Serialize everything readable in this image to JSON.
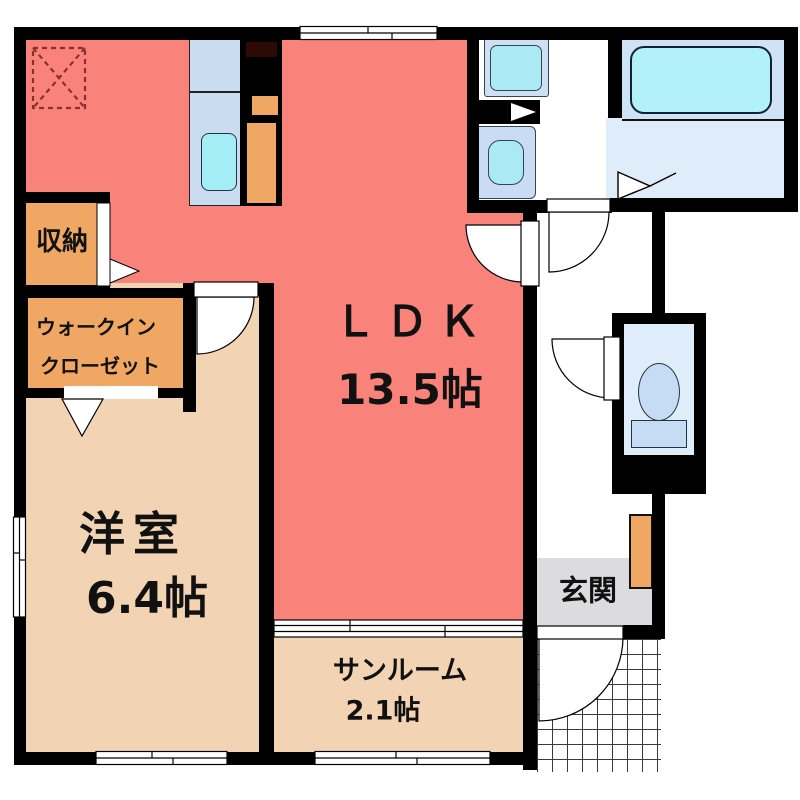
{
  "type": "apartment-floor-plan",
  "rooms": {
    "ldk": {
      "label": "ＬＤＫ",
      "area": "13.5帖",
      "color": "#f9837b"
    },
    "western_room": {
      "label": "洋室",
      "area": "6.4帖",
      "color": "#f2d4b5"
    },
    "sunroom": {
      "label": "サンルーム",
      "area": "2.1帖",
      "color": "#f2d4b5"
    },
    "storage": {
      "label": "収納",
      "color": "#f0a763"
    },
    "walk_in_closet": {
      "label_line1": "ウォークイン",
      "label_line2": "クローゼット",
      "color": "#f0a763"
    },
    "entrance": {
      "label": "玄関",
      "color": "#dcdcde"
    }
  },
  "fixtures": {
    "kitchen_counter": "kitchen-counter-with-sink",
    "refrigerator_space": "refrigerator-space",
    "washing_machine": "washing-machine-pan",
    "vanity": "vanity-sink",
    "bathtub": "bathtub",
    "toilet": "toilet",
    "shoe_cabinet": "shoe-cabinet",
    "ceiling_access": "ceiling-access-hatch",
    "entrance_porch": "tiled-porch"
  },
  "palette": {
    "wall": "#000000",
    "ldk_floor": "#f9837b",
    "room_floor": "#f2d4b5",
    "closet_orange": "#f0a763",
    "water_zone_blue": "#cfe2f6",
    "fixture_cyan": "#abeaf5",
    "bath_floor": "#dfecfa",
    "entrance_gray": "#dcdcde",
    "hatch_dashed_red": "#8a2f2f"
  }
}
